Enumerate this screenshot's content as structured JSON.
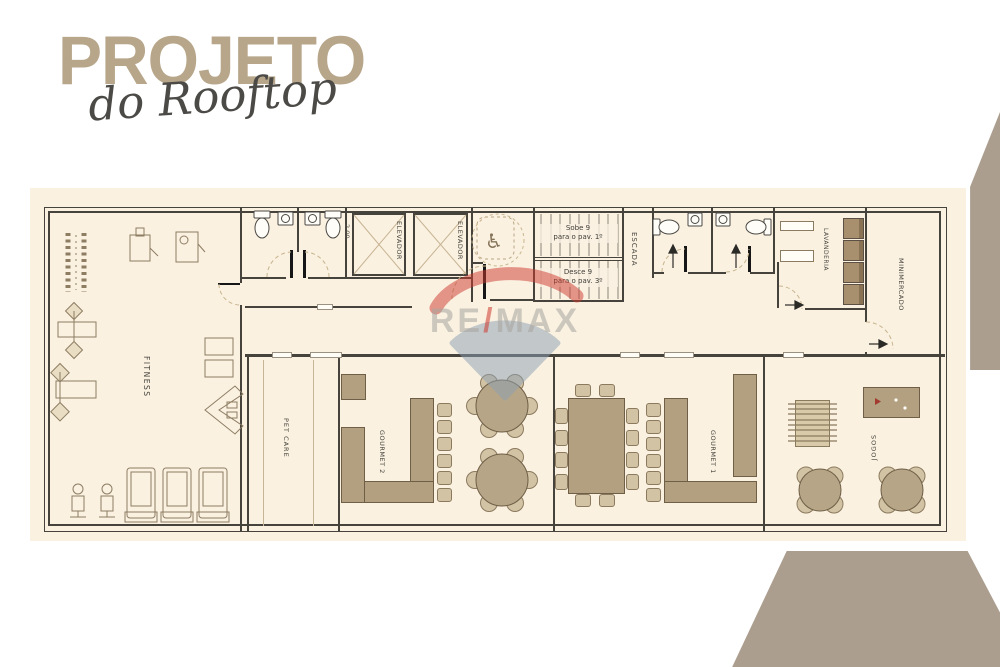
{
  "title": {
    "main": "PROJETO",
    "script": "do Rooftop"
  },
  "watermark": {
    "re": "RE",
    "slash": "/",
    "max": "MAX"
  },
  "labels": {
    "fitness": "FITNESS",
    "pet_care": "PET CARE",
    "gourmet2": "GOURMET 2",
    "gourmet1": "GOURMET 1",
    "jogos": "JOGOS",
    "elevador": "ELEVADOR",
    "escada": "ESCADA",
    "lavanderia": "LAVANDERIA",
    "minimercado": "MINIMERCADO",
    "dim": "2.00"
  },
  "stairs": {
    "up1": "Sobe 9",
    "up2": "para o pav. 1º",
    "down1": "Desce 9",
    "down2": "para o pav. 3º"
  },
  "icons": {
    "wheelchair": "♿"
  },
  "colors": {
    "cream": "#faf1e1",
    "taupe": "#ab9e8f",
    "tan": "#b2a080",
    "tan_light": "#d2c3a5",
    "wall": "#45433c",
    "title_tan": "#b7a68a",
    "ink": "#45433c",
    "remax_red": "#ce3a2e",
    "remax_blue": "#8ba0b3",
    "remax_gray": "#a8a5a0"
  }
}
